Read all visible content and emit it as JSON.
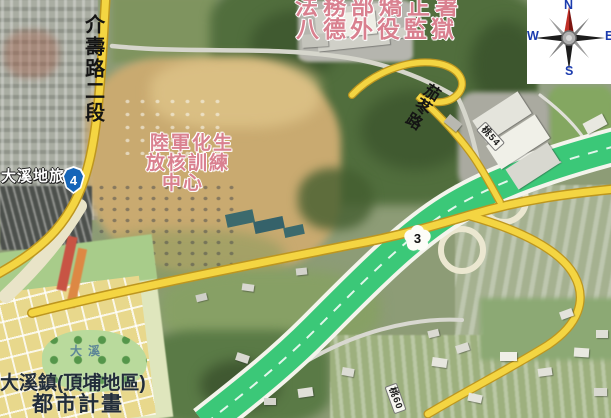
{
  "map": {
    "compass": {
      "n": "N",
      "e": "E",
      "s": "S",
      "w": "W"
    },
    "road_labels": {
      "jieshou_rd": "介壽路二段",
      "jiadong_rd": "茄苳路"
    },
    "place_labels": {
      "prison_line1": "法務部矯正署",
      "prison_line2": "八德外役監獄",
      "army_center_line1": "陸軍化生",
      "army_center_line2": "放核訓練",
      "army_center_line3": "中心",
      "hotel": "大溪地旅店",
      "urban_plan_line1": "大溪鎮(頂埔地區)",
      "urban_plan_line2": "都市計畫",
      "park": "大溪"
    },
    "route_shields": {
      "provincial_hwy": "4",
      "national_freeway": "3",
      "county_road_ne": "桃54",
      "county_road_s": "桃60"
    },
    "colors": {
      "freeway_green": "#3bc878",
      "road_yellow": "#f4d542",
      "provincial_shield_blue": "#1565b8",
      "label_pink": "#d9808f"
    }
  }
}
